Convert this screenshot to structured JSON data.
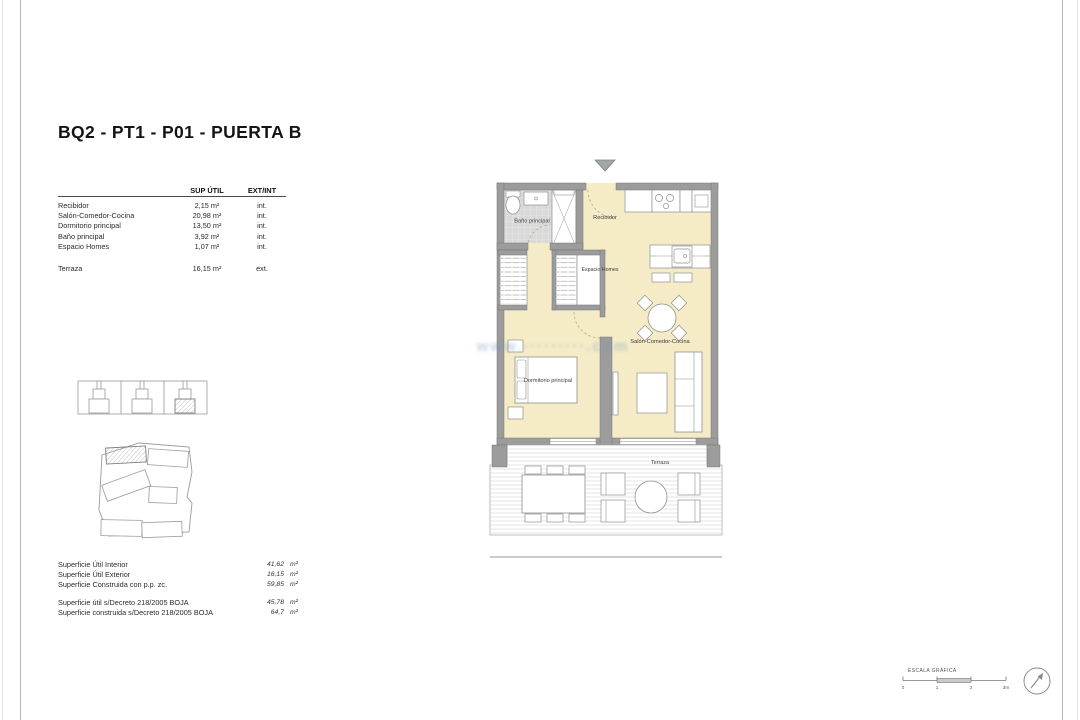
{
  "title": "BQ2 - PT1 - P01 - PUERTA B",
  "watermark": "www.·········.com",
  "areas_table": {
    "col_area": "SUP ÚTIL",
    "col_extint": "EXT/INT",
    "rows": [
      {
        "name": "Recibidor",
        "area": "2,15 m²",
        "extint": "int."
      },
      {
        "name": "Salón-Comedor-Cocina",
        "area": "20,98 m²",
        "extint": "int."
      },
      {
        "name": "Dormitorio principal",
        "area": "13,50 m²",
        "extint": "int."
      },
      {
        "name": "Baño principal",
        "area": "3,92 m²",
        "extint": "int."
      },
      {
        "name": "Espacio Homes",
        "area": "1,07 m²",
        "extint": "int."
      },
      {
        "name": "Terraza",
        "area": "16,15 m²",
        "extint": "ext."
      }
    ]
  },
  "plan_labels": {
    "bathroom": "Baño principal",
    "hall": "Recibidor",
    "homes": "Espacio Homes",
    "living": "Salón-Comedor-Cocina",
    "bedroom": "Dormitorio principal",
    "terrace": "Terraza"
  },
  "summary": {
    "group1": [
      {
        "label": "Superficie Útil Interior",
        "value": "41,62",
        "unit": "m²"
      },
      {
        "label": "Superficie Útil Exterior",
        "value": "16,15",
        "unit": "m²"
      },
      {
        "label": "Superficie Construida con p.p. zc.",
        "value": "59,85",
        "unit": "m²"
      }
    ],
    "group2": [
      {
        "label": "Superficie útil s/Decreto 218/2005 BOJA",
        "value": "45,78",
        "unit": "m²"
      },
      {
        "label": "Superficie construida s/Decreto 218/2005 BOJA",
        "value": "64,7",
        "unit": "m²"
      }
    ]
  },
  "scale_bar": {
    "label": "ESCALA GRÁFICA",
    "ticks": [
      "0",
      "1",
      "2",
      "3m"
    ]
  },
  "colors": {
    "floor": "#f5ecc7",
    "wall": "#9c9c9c",
    "tile": "#d9d9d9",
    "deck_stripe": "#e4e4e4"
  }
}
